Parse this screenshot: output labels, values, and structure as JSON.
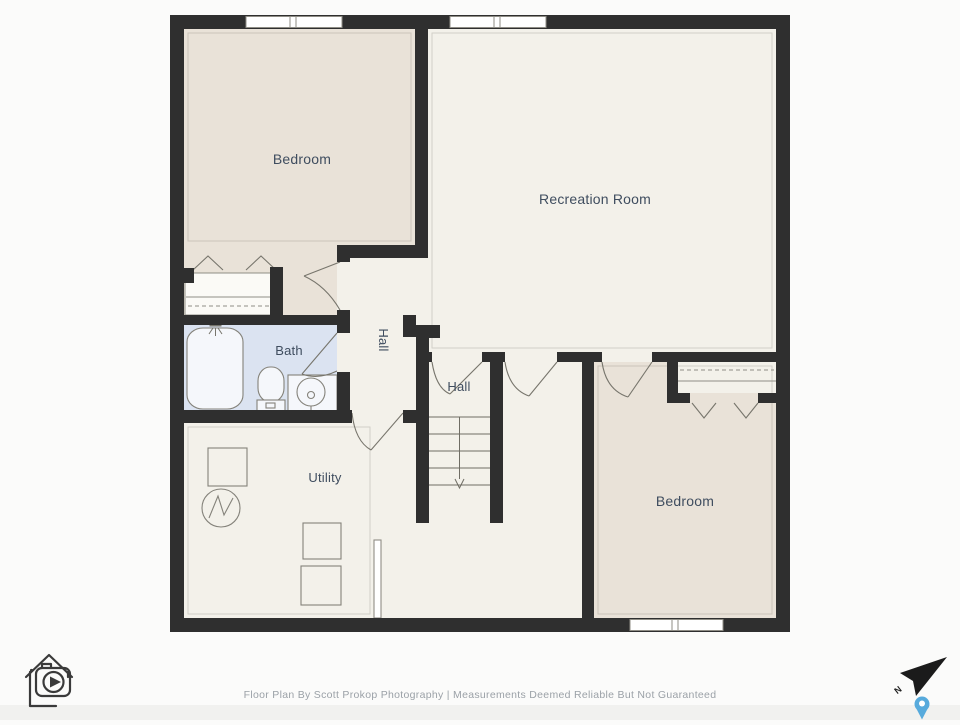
{
  "floor_plan": {
    "rooms": [
      {
        "id": "bedroom-upper",
        "label": "Bedroom",
        "fill": "#e9e2d8"
      },
      {
        "id": "recreation-room",
        "label": "Recreation Room",
        "fill": "#f3f1ea"
      },
      {
        "id": "bath",
        "label": "Bath",
        "fill": "#dbe3f1"
      },
      {
        "id": "hall-upper",
        "label": "Hall",
        "fill": "#f3f1ea"
      },
      {
        "id": "hall-stairs",
        "label": "Hall",
        "fill": "#f3f1ea"
      },
      {
        "id": "utility",
        "label": "Utility",
        "fill": "#f3f1ea"
      },
      {
        "id": "bedroom-lower",
        "label": "Bedroom",
        "fill": "#e9e2d8"
      }
    ],
    "colors": {
      "wall": "#2f2f2f",
      "floor_main": "#f3f1ea",
      "floor_bedroom": "#e9e2d8",
      "floor_bath": "#dbe3f1",
      "fixture_line": "#77756c",
      "label_text": "#3f4d5f",
      "pin_accent": "#57aadc"
    },
    "icons": {
      "logo": "house-camera-logo",
      "compass": "north-arrow",
      "pin": "location-pin"
    },
    "compass": {
      "north_label": "N"
    },
    "footer": {
      "credit": "Floor Plan By Scott Prokop Photography | Measurements Deemed Reliable But Not Guaranteed"
    }
  }
}
